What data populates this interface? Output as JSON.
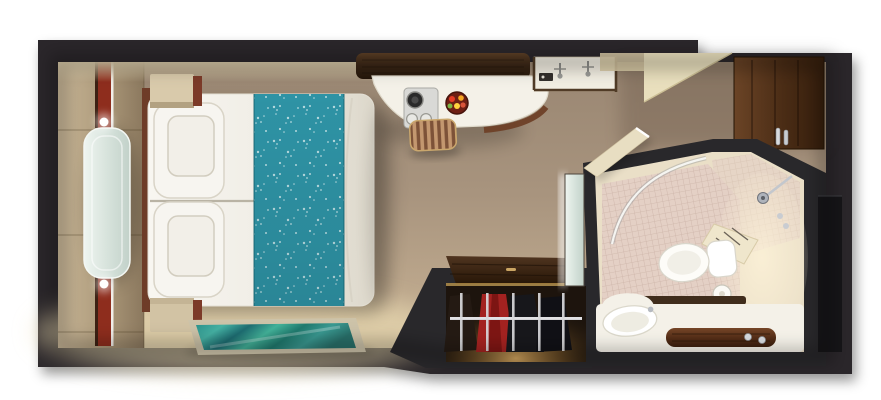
{
  "scene": {
    "kind": "3d-rendered top-down floor plan",
    "subject": "cruise-ship stateroom cabin"
  },
  "rooms": [
    {
      "id": "bedroom",
      "label": "bedroom"
    },
    {
      "id": "entry",
      "label": "entry hall"
    },
    {
      "id": "bathroom",
      "label": "bathroom"
    },
    {
      "id": "closet",
      "label": "wardrobe closet"
    }
  ],
  "objects": [
    {
      "id": "double-bed",
      "label": "double bed with white duvet and teal floral runner"
    },
    {
      "id": "pillows",
      "label": "two stacked pillow sets"
    },
    {
      "id": "nightstands",
      "label": "two bedside cabinets"
    },
    {
      "id": "glass-console",
      "label": "glass console on headboard wall"
    },
    {
      "id": "area-rug",
      "label": "teal striped area rug"
    },
    {
      "id": "vanity-desk",
      "label": "curved white vanity desk with wood shelf"
    },
    {
      "id": "coffee-set",
      "label": "coffee set and fruit bowl"
    },
    {
      "id": "stool",
      "label": "striped wood stool"
    },
    {
      "id": "wardrobe",
      "label": "open wardrobe with hanging garments"
    },
    {
      "id": "cabin-door",
      "label": "wood cabin entry door"
    },
    {
      "id": "bathroom-door",
      "label": "open bathroom door"
    },
    {
      "id": "shower",
      "label": "curved-glass shower with bench"
    },
    {
      "id": "toilet",
      "label": "toilet"
    },
    {
      "id": "sink",
      "label": "vanity sink counter with wood tray"
    }
  ],
  "colors": {
    "background": "#ffffff",
    "wall": "#29282b",
    "wall_recess": "#161518",
    "floor_taupe": "#a8947e",
    "floor_light": "#e2d5b4",
    "panel_tan": "#b3a083",
    "accent_red": "#8e2d1d",
    "glass": "#dbe7e0",
    "bedding_white": "#f2f0ea",
    "runner_teal": "#2e93a5",
    "rug_teal": "#2f928f",
    "rug_border": "#cdc3a9",
    "wood_dark": "#3b2917",
    "wood_red": "#5f3a25",
    "counter_white": "#f4f1e8",
    "tile_pink": "#e4d0c5",
    "bath_cream": "#eadfc7",
    "chrome": "#c9ccd1",
    "closet_shadow": "#1d140d",
    "garment_red": "#a32220",
    "garment_dark": "#17171b"
  }
}
